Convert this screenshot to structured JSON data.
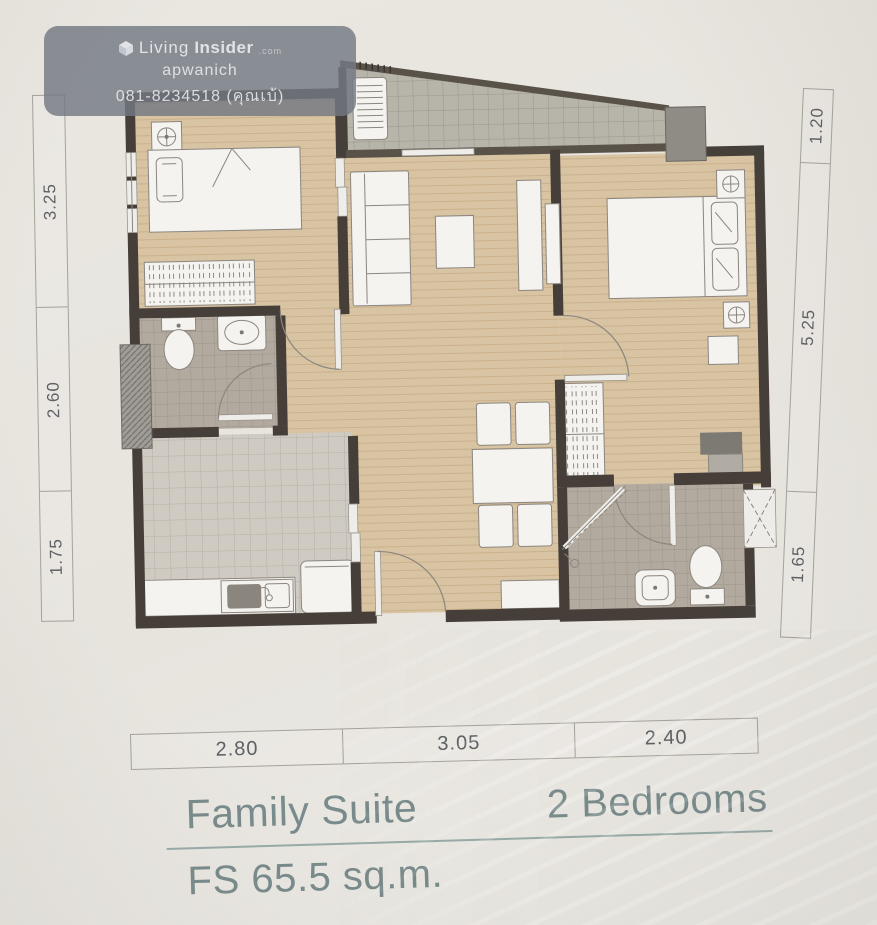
{
  "watermark": {
    "brand_prefix": "Living",
    "brand_bold": "Insider",
    "brand_suffix": ".com",
    "agent": "apwanich",
    "phone": "081-8234518 (คุณเบ้)"
  },
  "dimensions": {
    "left": [
      "3.25",
      "2.60",
      "1.75"
    ],
    "right": [
      "1.20",
      "5.25",
      "1.65"
    ],
    "bottom": [
      "2.80",
      "3.05",
      "2.40"
    ]
  },
  "title": {
    "unit_type": "Family Suite",
    "bedrooms": "2 Bedrooms",
    "area": "FS 65.5 sq.m."
  },
  "colors": {
    "wall": "#463f39",
    "wood_floor": "#d8c3a2",
    "bath_tile": "#b2aa9f",
    "kitchen_tile": "#cfcbc2",
    "balcony_tile": "#b7b4aa",
    "furniture": "#f4f3f0",
    "accent_text": "#798b8c",
    "dimension_text": "#5d6064",
    "watermark_bg": "rgba(116,121,131,0.82)"
  },
  "icons": [
    "bed-icon",
    "sofa-icon",
    "coffee-table-icon",
    "dining-table-icon",
    "chair-icon",
    "tv-icon",
    "wardrobe-icon",
    "dresser-icon",
    "toilet-icon",
    "sink-icon",
    "shower-icon",
    "kitchen-sink-icon",
    "fridge-icon",
    "counter-icon",
    "ac-fan-icon",
    "ac-condenser-icon",
    "door-swing-icon",
    "sliding-door-icon",
    "window-icon",
    "pillar-icon",
    "shaft-icon"
  ]
}
